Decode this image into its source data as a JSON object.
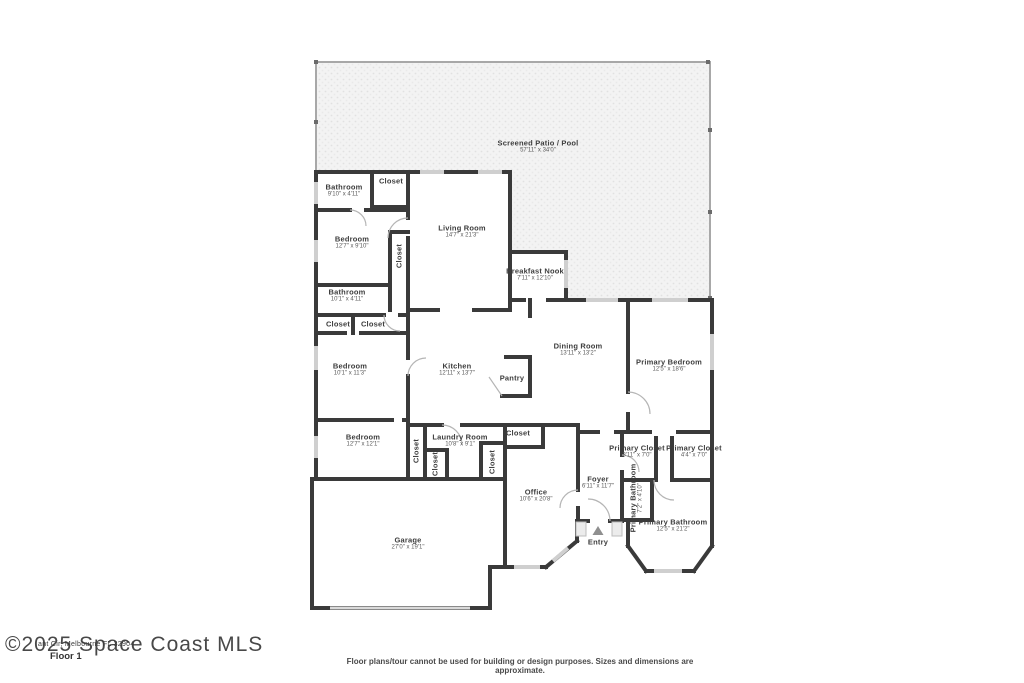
{
  "colors": {
    "wall": "#3a3a3a",
    "window": "#cfcfcf",
    "patio_fill": "#f3f3f3",
    "patio_dot": "#e1e1e1",
    "patio_border": "#a8a8a8",
    "label_text": "#3d3d3d"
  },
  "footer": {
    "watermark": "©2025 Space Coast MLS",
    "address_fragment": "ant Cir, Melbourne FL 32904",
    "floor_label": "Floor 1",
    "disclaimer": "Floor plans/tour cannot be used for building or design purposes. Sizes and dimensions are approximate."
  },
  "entry_marker": "▲",
  "rooms": [
    {
      "id": "screened-patio",
      "name": "Screened Patio / Pool",
      "dims": "57'11\" x 34'0\"",
      "x": 538,
      "y": 147
    },
    {
      "id": "bathroom-top",
      "name": "Bathroom",
      "dims": "9'10\" x 4'11\"",
      "x": 344,
      "y": 191
    },
    {
      "id": "closet-top",
      "name": "Closet",
      "x": 391,
      "y": 181
    },
    {
      "id": "bedroom-1",
      "name": "Bedroom",
      "dims": "12'7\" x 9'10\"",
      "x": 352,
      "y": 243
    },
    {
      "id": "closet-bedroom-1",
      "name": "Closet",
      "x": 399,
      "y": 256,
      "vertical": true
    },
    {
      "id": "living-room",
      "name": "Living Room",
      "dims": "14'7\" x 21'3\"",
      "x": 462,
      "y": 232
    },
    {
      "id": "breakfast-nook",
      "name": "Breakfast Nook",
      "dims": "7'11\" x 12'10\"",
      "x": 535,
      "y": 275
    },
    {
      "id": "bathroom-mid",
      "name": "Bathroom",
      "dims": "10'1\" x 4'11\"",
      "x": 347,
      "y": 296
    },
    {
      "id": "closet-hall-1",
      "name": "Closet",
      "x": 338,
      "y": 324
    },
    {
      "id": "closet-hall-2",
      "name": "Closet",
      "x": 373,
      "y": 324
    },
    {
      "id": "bedroom-2",
      "name": "Bedroom",
      "dims": "10'1\" x 11'3\"",
      "x": 350,
      "y": 370
    },
    {
      "id": "kitchen",
      "name": "Kitchen",
      "dims": "12'11\" x 13'7\"",
      "x": 457,
      "y": 370
    },
    {
      "id": "pantry",
      "name": "Pantry",
      "x": 512,
      "y": 378
    },
    {
      "id": "dining-room",
      "name": "Dining Room",
      "dims": "13'11\" x 13'2\"",
      "x": 578,
      "y": 350
    },
    {
      "id": "primary-bedroom",
      "name": "Primary Bedroom",
      "dims": "12'5\" x 18'6\"",
      "x": 669,
      "y": 366
    },
    {
      "id": "bedroom-3",
      "name": "Bedroom",
      "dims": "12'7\" x 12'1\"",
      "x": 363,
      "y": 441
    },
    {
      "id": "closet-bedroom-3",
      "name": "Closet",
      "x": 416,
      "y": 451,
      "vertical": true
    },
    {
      "id": "laundry-room",
      "name": "Laundry Room",
      "dims": "10'8\" x 9'1\"",
      "x": 460,
      "y": 441
    },
    {
      "id": "closet-laundry-1",
      "name": "Closet",
      "x": 435,
      "y": 464,
      "vertical": true
    },
    {
      "id": "closet-laundry-2",
      "name": "Closet",
      "x": 492,
      "y": 462,
      "vertical": true
    },
    {
      "id": "closet-office",
      "name": "Closet",
      "x": 518,
      "y": 433
    },
    {
      "id": "primary-closet-1",
      "name": "Primary Closet",
      "dims": "3'11\" x 7'0\"",
      "x": 637,
      "y": 452
    },
    {
      "id": "primary-closet-2",
      "name": "Primary Closet",
      "dims": "4'4\" x 7'0\"",
      "x": 694,
      "y": 452
    },
    {
      "id": "foyer",
      "name": "Foyer",
      "dims": "6'11\" x 11'7\"",
      "x": 598,
      "y": 483
    },
    {
      "id": "primary-bathroom-small",
      "name": "Primary Bathroom",
      "dims": "7'2\" x 4'10\"",
      "x": 637,
      "y": 498,
      "vertical": true
    },
    {
      "id": "office",
      "name": "Office",
      "dims": "10'6\" x 20'8\"",
      "x": 536,
      "y": 496
    },
    {
      "id": "primary-bathroom",
      "name": "Primary Bathroom",
      "dims": "12'5\" x 21'2\"",
      "x": 673,
      "y": 526
    },
    {
      "id": "garage",
      "name": "Garage",
      "dims": "27'0\" x 19'1\"",
      "x": 408,
      "y": 544
    },
    {
      "id": "entry",
      "name": "Entry",
      "x": 598,
      "y": 542
    }
  ]
}
